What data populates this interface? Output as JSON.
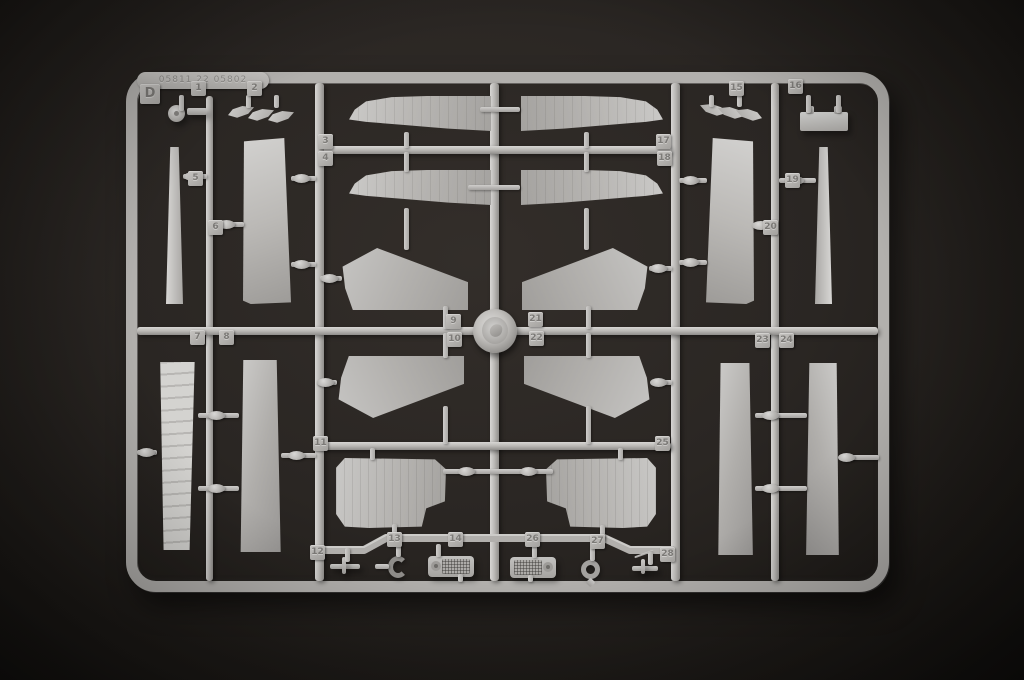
{
  "scene": {
    "type": "photograph",
    "subject": "Light grey injection-moulded plastic model kit sprue (runner D) with numbered aircraft parts, photographed on a dark backdrop",
    "background_color": "#2a2623",
    "plastic_color": "#b6b4b1"
  },
  "sprue": {
    "letter": "D",
    "mold_text": "05811 22 05802",
    "part_tags": [
      {
        "n": "1",
        "x": 191,
        "y": 81
      },
      {
        "n": "2",
        "x": 247,
        "y": 81
      },
      {
        "n": "3",
        "x": 318,
        "y": 134
      },
      {
        "n": "4",
        "x": 318,
        "y": 151
      },
      {
        "n": "5",
        "x": 188,
        "y": 171
      },
      {
        "n": "6",
        "x": 208,
        "y": 220
      },
      {
        "n": "7",
        "x": 190,
        "y": 330
      },
      {
        "n": "8",
        "x": 219,
        "y": 330
      },
      {
        "n": "9",
        "x": 446,
        "y": 314
      },
      {
        "n": "10",
        "x": 447,
        "y": 332
      },
      {
        "n": "11",
        "x": 313,
        "y": 436
      },
      {
        "n": "12",
        "x": 310,
        "y": 545
      },
      {
        "n": "13",
        "x": 387,
        "y": 532
      },
      {
        "n": "14",
        "x": 448,
        "y": 532
      },
      {
        "n": "15",
        "x": 729,
        "y": 81
      },
      {
        "n": "16",
        "x": 788,
        "y": 79
      },
      {
        "n": "17",
        "x": 656,
        "y": 134
      },
      {
        "n": "18",
        "x": 657,
        "y": 151
      },
      {
        "n": "19",
        "x": 785,
        "y": 173
      },
      {
        "n": "20",
        "x": 763,
        "y": 220
      },
      {
        "n": "21",
        "x": 528,
        "y": 312
      },
      {
        "n": "22",
        "x": 529,
        "y": 331
      },
      {
        "n": "23",
        "x": 755,
        "y": 333
      },
      {
        "n": "24",
        "x": 779,
        "y": 333
      },
      {
        "n": "25",
        "x": 655,
        "y": 436
      },
      {
        "n": "26",
        "x": 525,
        "y": 532
      },
      {
        "n": "27",
        "x": 590,
        "y": 534
      },
      {
        "n": "28",
        "x": 660,
        "y": 547
      }
    ]
  }
}
